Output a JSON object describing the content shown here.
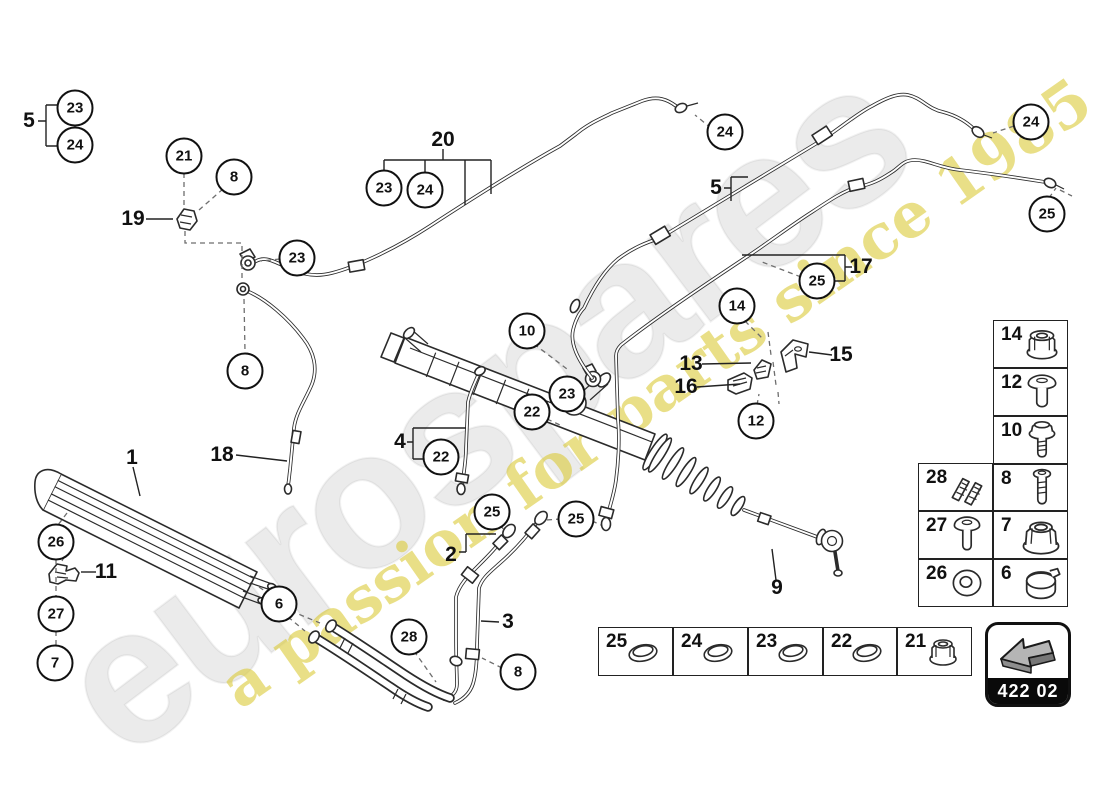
{
  "watermark": {
    "logo": "eurospares",
    "tagline": "a passion for parts since 1985"
  },
  "diagram_code": "422 02",
  "callouts": [
    {
      "n": "23",
      "x": 75,
      "y": 108
    },
    {
      "n": "24",
      "x": 75,
      "y": 145
    },
    {
      "n": "21",
      "x": 184,
      "y": 156
    },
    {
      "n": "8",
      "x": 234,
      "y": 177
    },
    {
      "n": "23",
      "x": 384,
      "y": 188
    },
    {
      "n": "24",
      "x": 425,
      "y": 190
    },
    {
      "n": "23",
      "x": 297,
      "y": 258
    },
    {
      "n": "8",
      "x": 245,
      "y": 371
    },
    {
      "n": "24",
      "x": 725,
      "y": 132
    },
    {
      "n": "24",
      "x": 1031,
      "y": 122
    },
    {
      "n": "25",
      "x": 1047,
      "y": 214
    },
    {
      "n": "25",
      "x": 817,
      "y": 281
    },
    {
      "n": "14",
      "x": 737,
      "y": 306
    },
    {
      "n": "12",
      "x": 756,
      "y": 421
    },
    {
      "n": "10",
      "x": 527,
      "y": 331
    },
    {
      "n": "22",
      "x": 532,
      "y": 412
    },
    {
      "n": "23",
      "x": 567,
      "y": 394
    },
    {
      "n": "22",
      "x": 441,
      "y": 457
    },
    {
      "n": "25",
      "x": 492,
      "y": 512
    },
    {
      "n": "25",
      "x": 576,
      "y": 519
    },
    {
      "n": "26",
      "x": 56,
      "y": 542
    },
    {
      "n": "27",
      "x": 56,
      "y": 614
    },
    {
      "n": "7",
      "x": 55,
      "y": 663
    },
    {
      "n": "6",
      "x": 279,
      "y": 604
    },
    {
      "n": "28",
      "x": 409,
      "y": 637
    },
    {
      "n": "8",
      "x": 518,
      "y": 672
    }
  ],
  "labels": [
    {
      "n": "5",
      "x": 29,
      "y": 121
    },
    {
      "n": "19",
      "x": 133,
      "y": 219
    },
    {
      "n": "20",
      "x": 443,
      "y": 140
    },
    {
      "n": "5",
      "x": 716,
      "y": 188
    },
    {
      "n": "17",
      "x": 861,
      "y": 267
    },
    {
      "n": "13",
      "x": 691,
      "y": 364
    },
    {
      "n": "16",
      "x": 686,
      "y": 387
    },
    {
      "n": "15",
      "x": 841,
      "y": 355
    },
    {
      "n": "1",
      "x": 132,
      "y": 458
    },
    {
      "n": "18",
      "x": 222,
      "y": 455
    },
    {
      "n": "11",
      "x": 106,
      "y": 572
    },
    {
      "n": "4",
      "x": 400,
      "y": 442
    },
    {
      "n": "2",
      "x": 451,
      "y": 555
    },
    {
      "n": "3",
      "x": 508,
      "y": 622
    },
    {
      "n": "9",
      "x": 777,
      "y": 588
    }
  ],
  "parts_table": {
    "right_column": [
      {
        "num": "14",
        "icon": "flange-nut"
      },
      {
        "num": "12",
        "icon": "pan-screw"
      },
      {
        "num": "10",
        "icon": "stud-nut"
      },
      {
        "num": "8",
        "icon": "bolt"
      },
      {
        "num": "7",
        "icon": "flange-nut-large"
      },
      {
        "num": "6",
        "icon": "clamp-ring"
      }
    ],
    "left_column": [
      {
        "num": "28",
        "icon": "spring-clips"
      },
      {
        "num": "27",
        "icon": "rivet-screw"
      },
      {
        "num": "26",
        "icon": "washer"
      }
    ]
  },
  "seals_table": [
    {
      "num": "25",
      "icon": "seal-ring"
    },
    {
      "num": "24",
      "icon": "seal-ring"
    },
    {
      "num": "23",
      "icon": "seal-ring"
    },
    {
      "num": "22",
      "icon": "seal-ring"
    },
    {
      "num": "21",
      "icon": "flange-nut-small"
    }
  ]
}
